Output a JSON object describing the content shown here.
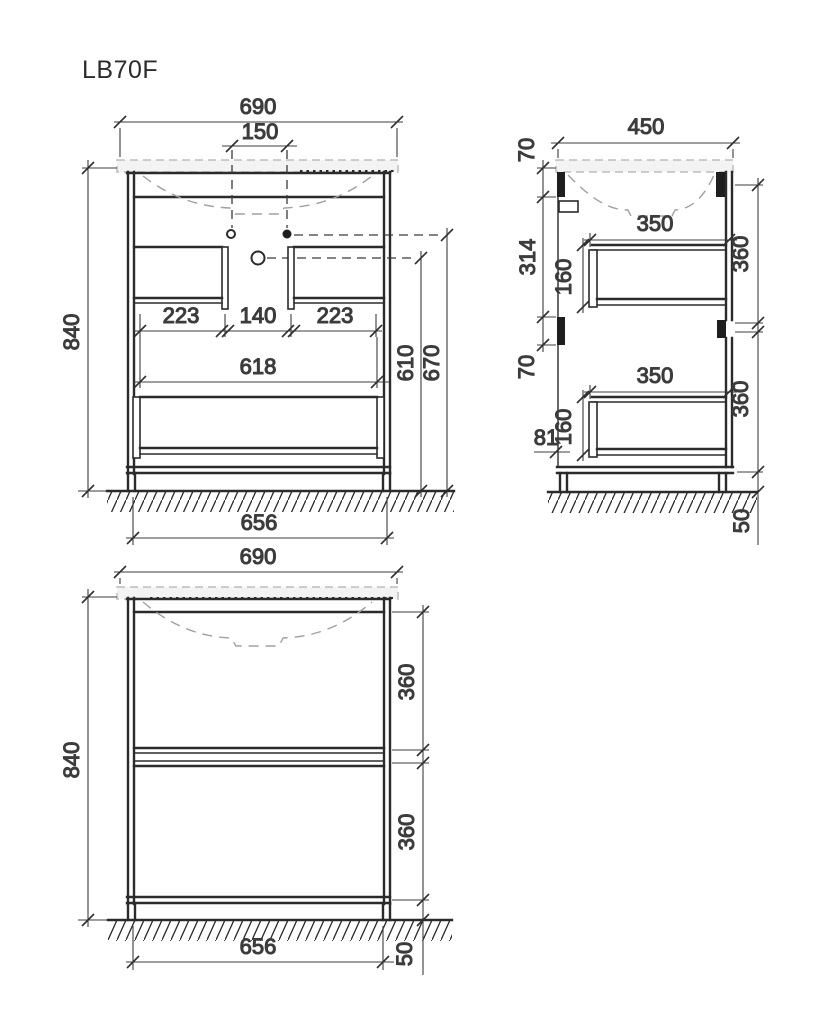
{
  "title": "LB70F",
  "colors": {
    "line": "#2b2b2b",
    "dim_text": "#3d3d3d",
    "hidden_line": "#a0a0a0",
    "countertop_fill": "#f3f3f3",
    "background": "#ffffff"
  },
  "front_view": {
    "overall_width": "690",
    "tap_hole_spacing": "150",
    "overall_height": "840",
    "left_box_width": "223",
    "center_gap": "140",
    "right_box_width": "223",
    "inner_width": "618",
    "drain_height": "610",
    "tap_height": "670",
    "footprint_width": "656"
  },
  "side_view": {
    "overall_depth": "450",
    "top_bracket_height": "70",
    "panel_gap": "314",
    "mid_bracket_height": "70",
    "upper_drawer_depth": "350",
    "upper_drawer_side": "160",
    "upper_front_height": "360",
    "lower_drawer_depth": "350",
    "lower_drawer_side": "160",
    "lower_front_height": "360",
    "bottom_offset": "81",
    "leg_height": "50"
  },
  "front_elevation": {
    "overall_width": "690",
    "overall_height": "840",
    "upper_front_height": "360",
    "lower_front_height": "360",
    "footprint_width": "656",
    "leg_height": "50"
  }
}
